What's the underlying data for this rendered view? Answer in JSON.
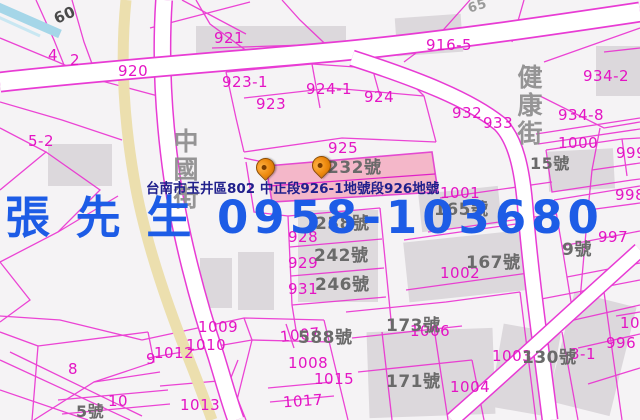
{
  "overlay": {
    "contact": "張 先 生 0958-103680",
    "listing": "台南市玉井區802 中正段926-1地號段926地號"
  },
  "streets": [
    {
      "name": "中國街",
      "x": 166,
      "y": 128
    },
    {
      "name": "健康街",
      "x": 510,
      "y": 64
    }
  ],
  "labels": {
    "magenta": [
      {
        "t": "921",
        "x": 214,
        "y": 31
      },
      {
        "t": "920",
        "x": 118,
        "y": 64
      },
      {
        "t": "923-1",
        "x": 222,
        "y": 75
      },
      {
        "t": "923",
        "x": 256,
        "y": 97
      },
      {
        "t": "924-1",
        "x": 306,
        "y": 82
      },
      {
        "t": "924",
        "x": 364,
        "y": 90
      },
      {
        "t": "916-5",
        "x": 426,
        "y": 38
      },
      {
        "t": "934-2",
        "x": 583,
        "y": 69
      },
      {
        "t": "934-8",
        "x": 558,
        "y": 108
      },
      {
        "t": "933",
        "x": 483,
        "y": 116
      },
      {
        "t": "932",
        "x": 452,
        "y": 106
      },
      {
        "t": "925",
        "x": 328,
        "y": 141
      },
      {
        "t": "1000",
        "x": 558,
        "y": 136
      },
      {
        "t": "999",
        "x": 616,
        "y": 146
      },
      {
        "t": "998",
        "x": 615,
        "y": 188
      },
      {
        "t": "997",
        "x": 598,
        "y": 230
      },
      {
        "t": "1001",
        "x": 440,
        "y": 186
      },
      {
        "t": "928",
        "x": 288,
        "y": 230
      },
      {
        "t": "929",
        "x": 288,
        "y": 256
      },
      {
        "t": "931",
        "x": 288,
        "y": 282
      },
      {
        "t": "1002",
        "x": 440,
        "y": 266
      },
      {
        "t": "996",
        "x": 606,
        "y": 336
      },
      {
        "t": "1009",
        "x": 198,
        "y": 320
      },
      {
        "t": "1007",
        "x": 280,
        "y": 328,
        "r": -6
      },
      {
        "t": "1012",
        "x": 154,
        "y": 346
      },
      {
        "t": "1010",
        "x": 186,
        "y": 338
      },
      {
        "t": "1008",
        "x": 288,
        "y": 356
      },
      {
        "t": "1006",
        "x": 410,
        "y": 324
      },
      {
        "t": "1015",
        "x": 314,
        "y": 372
      },
      {
        "t": "1004",
        "x": 450,
        "y": 380
      },
      {
        "t": "1003",
        "x": 492,
        "y": 349
      },
      {
        "t": "3-1",
        "x": 570,
        "y": 347
      },
      {
        "t": "1013",
        "x": 180,
        "y": 398
      },
      {
        "t": "1017",
        "x": 283,
        "y": 394,
        "r": -4
      },
      {
        "t": "10",
        "x": 108,
        "y": 394
      },
      {
        "t": "9",
        "x": 146,
        "y": 352
      },
      {
        "t": "8",
        "x": 68,
        "y": 362
      },
      {
        "t": "5-2",
        "x": 28,
        "y": 134
      },
      {
        "t": "4",
        "x": 48,
        "y": 48
      },
      {
        "t": "2",
        "x": 70,
        "y": 53
      },
      {
        "t": "10",
        "x": 620,
        "y": 316
      }
    ],
    "gray": [
      {
        "t": "232號",
        "x": 327,
        "y": 160,
        "s": 17
      },
      {
        "t": "238號",
        "x": 315,
        "y": 216,
        "s": 17
      },
      {
        "t": "242號",
        "x": 314,
        "y": 248,
        "s": 17
      },
      {
        "t": "246號",
        "x": 315,
        "y": 277,
        "s": 17
      },
      {
        "t": "165號",
        "x": 434,
        "y": 202,
        "s": 17
      },
      {
        "t": "167號",
        "x": 466,
        "y": 255,
        "s": 17
      },
      {
        "t": "15號",
        "x": 530,
        "y": 156,
        "s": 16
      },
      {
        "t": "9號",
        "x": 562,
        "y": 242,
        "s": 17
      },
      {
        "t": "588號",
        "x": 298,
        "y": 330,
        "s": 17
      },
      {
        "t": "173號",
        "x": 386,
        "y": 318,
        "s": 17
      },
      {
        "t": "130號",
        "x": 522,
        "y": 350,
        "s": 17
      },
      {
        "t": "171號",
        "x": 386,
        "y": 374,
        "s": 17
      },
      {
        "t": "5號",
        "x": 76,
        "y": 404,
        "s": 16
      },
      {
        "t": "60",
        "x": 54,
        "y": 8,
        "r": -24,
        "c": "#4a4a4a",
        "s": 15
      },
      {
        "t": "65",
        "x": 468,
        "y": 0,
        "r": -18,
        "c": "#9a9a9a",
        "s": 13
      }
    ]
  },
  "markers": [
    {
      "x": 256,
      "y": 158
    },
    {
      "x": 312,
      "y": 156
    }
  ],
  "colors": {
    "parcel_line": "#ea2cd0",
    "magenta_label": "#e414c4",
    "gray_label": "#6a6a6a",
    "contact_blue": "#1d5ce6",
    "listing_navy": "#20208c",
    "highlight_fill": "#f4a9bf",
    "marker_orange": "#ee8a0e",
    "road_tan": "#ecdfae",
    "water_blue": "#a5d6e8",
    "building_gray": "#dcd8dc"
  }
}
